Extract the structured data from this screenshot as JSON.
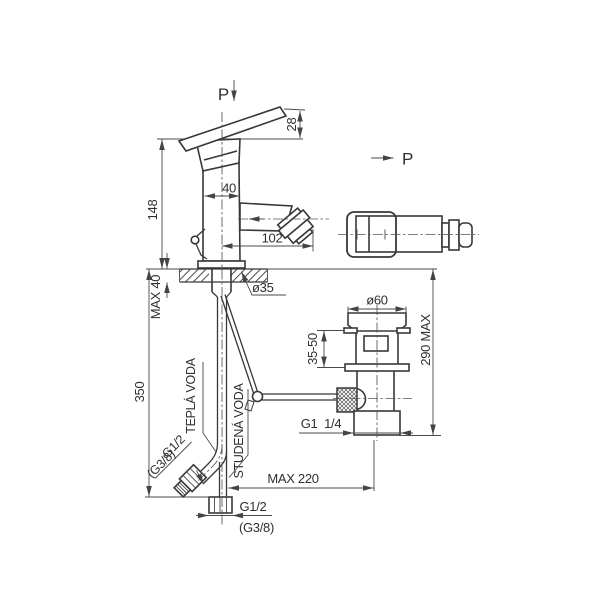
{
  "page": {
    "background": "#ffffff",
    "description": "Dimensioned technical drawing of a single-lever bidet mixer tap with pop-up waste, side view and top view"
  },
  "drawing": {
    "line_color": "#383838",
    "views": {
      "side_view_label": "P",
      "top_view_label": "P"
    },
    "labels": {
      "hot_water": "TEPLÁ VODA",
      "cold_water": "STUDENÁ VODA"
    },
    "dims": {
      "lever_rise": "28",
      "height_above_deck": "148",
      "body_width": "40",
      "spout_reach": "102",
      "deck_thickness": "MAX 40",
      "mount_hole": "ø35",
      "supply_pipe_length": "350",
      "hot_supply_thread": "G1/2",
      "hot_supply_thread_alt": "(G3/8)",
      "cold_supply_thread": "G1/2",
      "cold_supply_thread_alt": "(G3/8)",
      "waste_offset": "MAX 220",
      "waste_thread": "G1  1/4",
      "waste_flange_dia": "ø60",
      "waste_top_range": "35-50",
      "waste_height": "290 MAX"
    }
  }
}
